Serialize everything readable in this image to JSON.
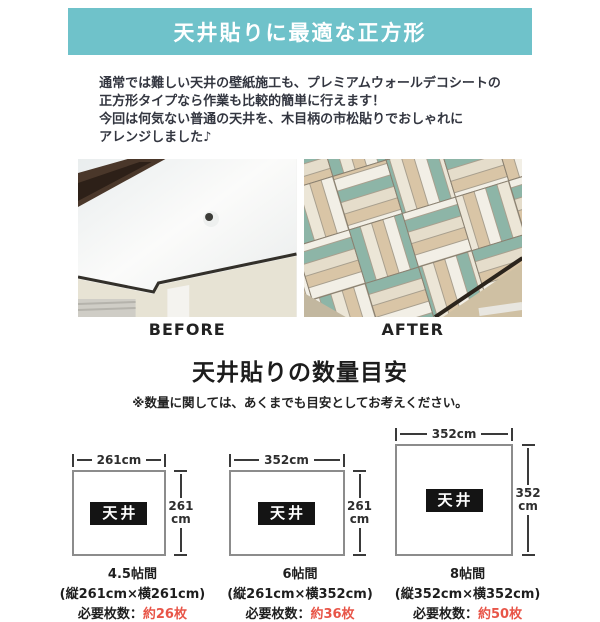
{
  "banner": {
    "title": "天井貼りに最適な正方形"
  },
  "intro": {
    "lines": [
      "通常では難しい天井の壁紙施工も、プレミアムウォールデコシートの",
      "正方形タイプなら作業も比較的簡単に行えます！",
      "今回は何気ない普通の天井を、木目柄の市松貼りでおしゃれに",
      "アレンジしました♪"
    ]
  },
  "comparison": {
    "before_label": "BEFORE",
    "after_label": "AFTER"
  },
  "quantity_section": {
    "title": "天井貼りの数量目安",
    "note": "※数量に関しては、あくまでも目安としてお考えください。",
    "ceiling_label": "天井",
    "items": [
      {
        "name": "4.5帖間",
        "width_label": "261cm",
        "height_value": "261",
        "height_unit": "cm",
        "dimensions": "(縦261cm×横261cm)",
        "required_label": "必要枚数：",
        "required_value": "約26枚"
      },
      {
        "name": "6帖間",
        "width_label": "352cm",
        "height_value": "261",
        "height_unit": "cm",
        "dimensions": "(縦261cm×横352cm)",
        "required_label": "必要枚数：",
        "required_value": "約36枚"
      },
      {
        "name": "8帖間",
        "width_label": "352cm",
        "height_value": "352",
        "height_unit": "cm",
        "dimensions": "(縦352cm×横352cm)",
        "required_label": "必要枚数：",
        "required_value": "約50枚"
      }
    ]
  },
  "colors": {
    "banner_bg": "#6fc2ca",
    "accent_red": "#e85548",
    "plank_teal": "#8db5a7",
    "plank_cream": "#ece6d7",
    "plank_tan": "#d9c5a6"
  }
}
